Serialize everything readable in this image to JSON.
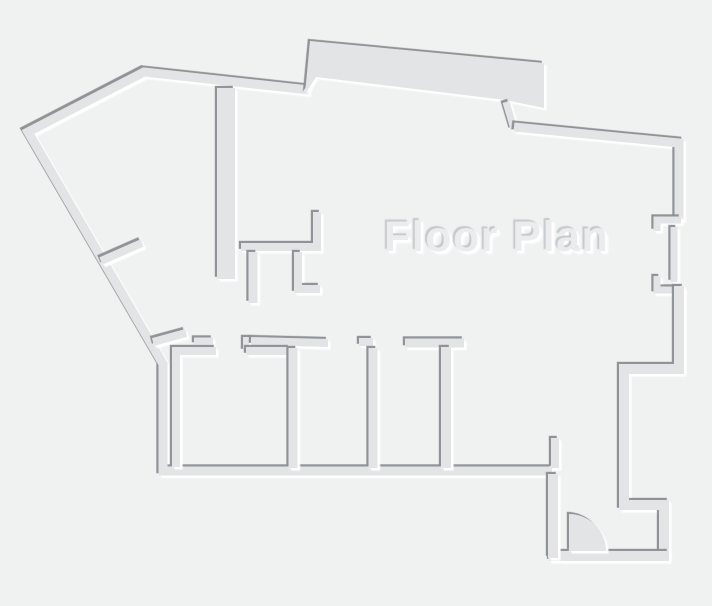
{
  "title": {
    "text": "Floor Plan"
  },
  "canvas": {
    "width": 712,
    "height": 606
  },
  "colors": {
    "background": "#f0f1f1",
    "wall_fill": "#e2e4e5",
    "shadow_dark": "#8a9093",
    "shadow_light": "#ffffff",
    "title_fill": "#eaeced",
    "title_shadow_dark": "#c5cacc",
    "title_shadow_light": "#ffffff"
  },
  "floor_plan": {
    "walls": [
      {
        "name": "outer-wall-left-and-bottom",
        "type": "path",
        "d": "M 309,90 L 144,72 L 28,132 L 163,364 L 163,471 L 552,471",
        "w": 9
      },
      {
        "name": "outer-wall-top-bump",
        "type": "polygon",
        "points": "305,94 310,41 544,63 544,108 505,100 316,77"
      },
      {
        "name": "outer-wall-top-connector",
        "type": "path",
        "d": "M 506,102 L 514,129",
        "w": 7
      },
      {
        "name": "outer-wall-top-right",
        "type": "path",
        "d": "M 514,127 L 679,143 L 679,220",
        "w": 9
      },
      {
        "name": "window-bracket-top",
        "type": "path",
        "d": "M 681,220 L 657,220 L 657,231",
        "w": 7
      },
      {
        "name": "window-inner-wall",
        "type": "path",
        "d": "M 674,227 L 674,282",
        "w": 7
      },
      {
        "name": "window-bracket-bottom",
        "type": "path",
        "d": "M 657,276 L 657,290 L 682,290",
        "w": 7
      },
      {
        "name": "outer-wall-right-and-vestibule",
        "type": "path",
        "d": "M 679,286 L 679,369 L 624,369 L 624,505 L 664,505 L 664,556",
        "w": 10
      },
      {
        "name": "vestibule-bottom-wall",
        "type": "path",
        "d": "M 549,556 L 669,556",
        "w": 10
      },
      {
        "name": "vestibule-left-wall",
        "type": "path",
        "d": "M 553,474 L 553,558",
        "w": 10
      },
      {
        "name": "door-jamb-stub",
        "type": "path",
        "d": "M 555,438 L 555,468",
        "w": 8
      },
      {
        "name": "interior-wall-vertical-long",
        "type": "path",
        "d": "M 226,88 L 226,279",
        "w": 18
      },
      {
        "name": "interior-wall-j-shape",
        "type": "path",
        "d": "M 241,247 L 317,247 L 317,212",
        "w": 8
      },
      {
        "name": "closet-stub-left",
        "type": "path",
        "d": "M 253,252 L 253,303",
        "w": 9
      },
      {
        "name": "closet-wall-l-shape",
        "type": "path",
        "d": "M 298,252 L 298,289 L 320,289",
        "w": 8
      },
      {
        "name": "door-stub-upper-diagonal",
        "type": "path",
        "d": "M 101,261 L 142,243",
        "w": 8
      },
      {
        "name": "door-stub-lower-diagonal",
        "type": "path",
        "d": "M 153,342 L 186,333",
        "w": 8
      },
      {
        "name": "wall-fragment-horizontal",
        "type": "path",
        "d": "M 194,341 L 213,341",
        "w": 7
      },
      {
        "name": "corridor-step-wall",
        "type": "path",
        "d": "M 246,351 L 246,340 L 250,340 L 250,337",
        "w": 6
      },
      {
        "name": "corridor-wall",
        "type": "path",
        "d": "M 251,341 L 328,343",
        "w": 8
      },
      {
        "name": "room1-corner-wall",
        "type": "path",
        "d": "M 216,351 L 176,351 L 176,467",
        "w": 8
      },
      {
        "name": "room1-top-wall",
        "type": "path",
        "d": "M 246,351 L 290,351",
        "w": 8
      },
      {
        "name": "room-divider-a",
        "type": "path",
        "d": "M 293,348 L 293,468",
        "w": 9
      },
      {
        "name": "divider-b-top-stub",
        "type": "path",
        "d": "M 359,342 L 373,342",
        "w": 8
      },
      {
        "name": "room-divider-b",
        "type": "path",
        "d": "M 373,348 L 373,468",
        "w": 9
      },
      {
        "name": "t-wall-horizontal",
        "type": "path",
        "d": "M 405,343 L 464,343",
        "w": 9
      },
      {
        "name": "room-divider-t",
        "type": "path",
        "d": "M 446,347 L 446,468",
        "w": 10
      }
    ],
    "door": {
      "name": "door-swing",
      "d": "M 569,551 L 569,514 A 37,37 0 0 1 606,551 Z"
    }
  }
}
